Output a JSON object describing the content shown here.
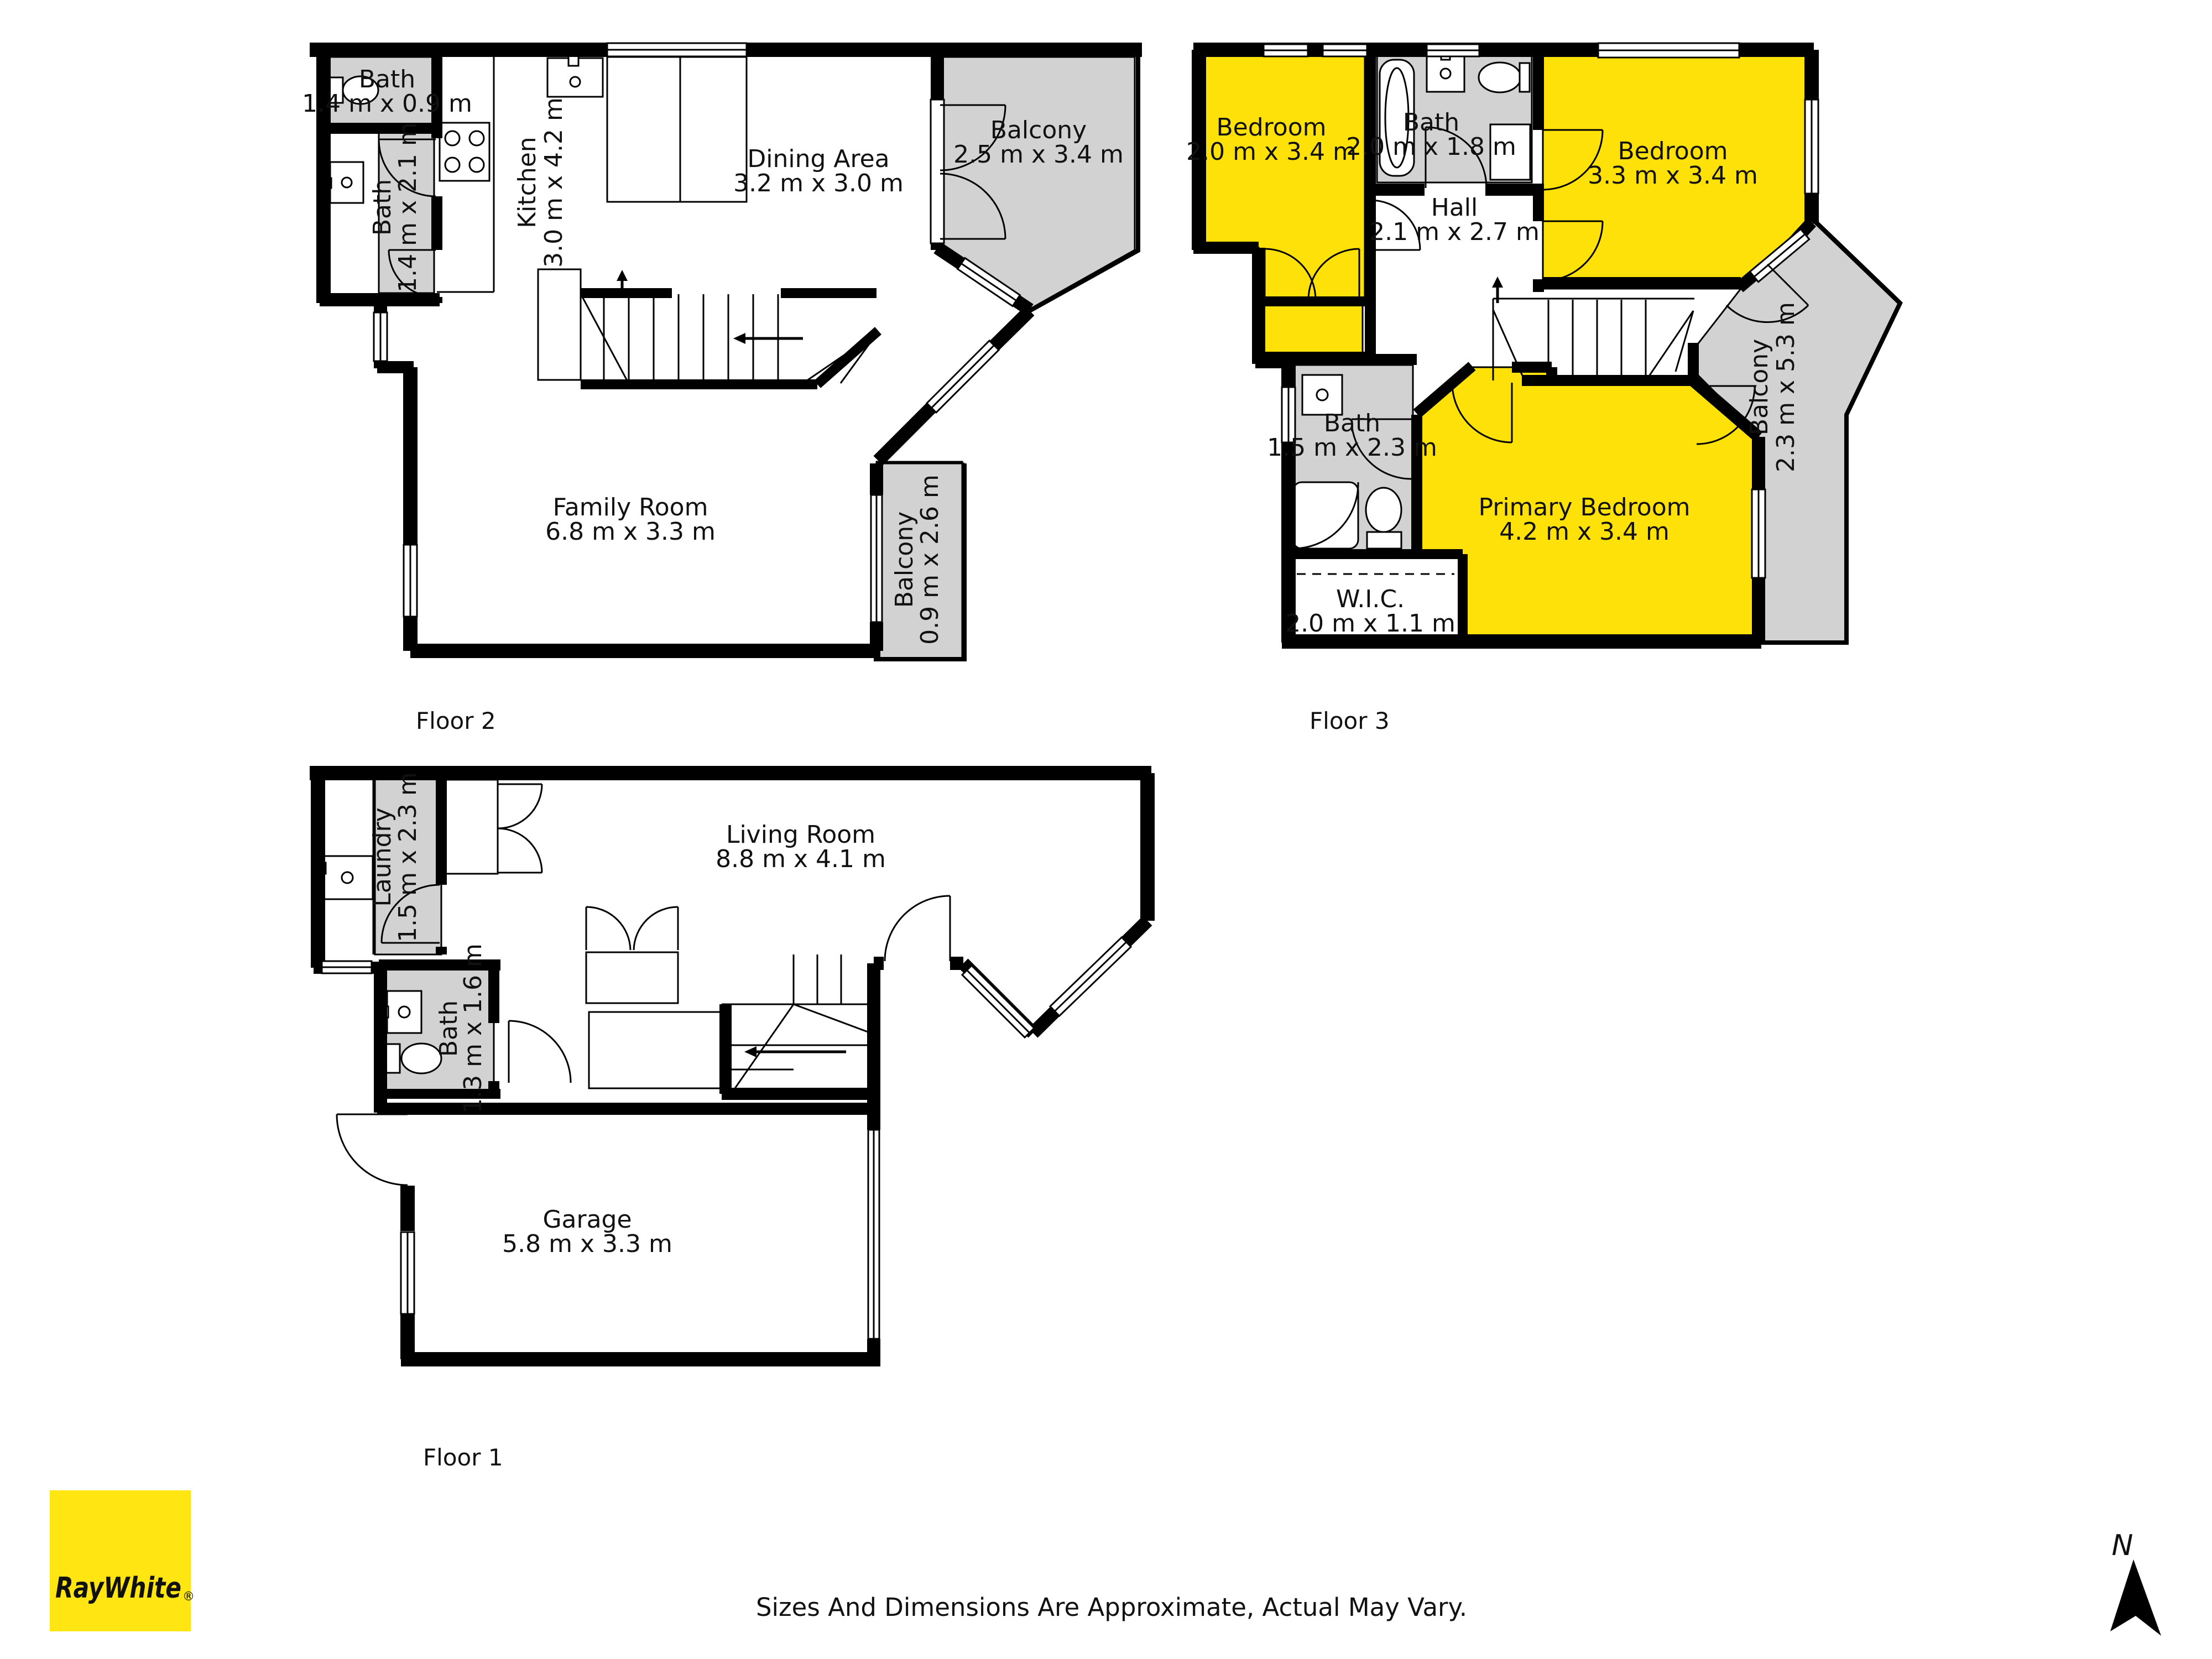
{
  "colors": {
    "room_highlight": "#ffe10a",
    "outdoor_gray": "#d2d2d2",
    "wall": "#000000",
    "logo_bg": "#ffe512",
    "logo_fg": "#57585c"
  },
  "floor2": {
    "label": "Floor 2",
    "rooms": {
      "bath_a": {
        "name": "Bath",
        "dims": "1.4 m x 0.9 m"
      },
      "bath_b": {
        "name": "Bath",
        "dims": "1.4 m x 2.1 m"
      },
      "kitchen": {
        "name": "Kitchen",
        "dims": "3.0 m x 4.2 m"
      },
      "dining": {
        "name": "Dining Area",
        "dims": "3.2 m x 3.0 m"
      },
      "balcony_a": {
        "name": "Balcony",
        "dims": "2.5 m x 3.4 m"
      },
      "family": {
        "name": "Family Room",
        "dims": "6.8 m x 3.3 m"
      },
      "balcony_b": {
        "name": "Balcony",
        "dims": "0.9 m x 2.6 m"
      }
    }
  },
  "floor3": {
    "label": "Floor 3",
    "rooms": {
      "bedroom_a": {
        "name": "Bedroom",
        "dims": "2.0 m x 3.4 m"
      },
      "bath_a": {
        "name": "Bath",
        "dims": "2.0 m x 1.8 m"
      },
      "bedroom_b": {
        "name": "Bedroom",
        "dims": "3.3 m x 3.4 m"
      },
      "hall": {
        "name": "Hall",
        "dims": "2.1 m x 2.7 m"
      },
      "balcony": {
        "name": "Balcony",
        "dims": "2.3 m x 5.3 m"
      },
      "bath_b": {
        "name": "Bath",
        "dims": "1.5 m x 2.3 m"
      },
      "primary": {
        "name": "Primary Bedroom",
        "dims": "4.2 m x 3.4 m"
      },
      "wic": {
        "name": "W.I.C.",
        "dims": "2.0 m x 1.1 m"
      }
    }
  },
  "floor1": {
    "label": "Floor 1",
    "rooms": {
      "laundry": {
        "name": "Laundry",
        "dims": "1.5 m x 2.3 m"
      },
      "living": {
        "name": "Living Room",
        "dims": "8.8 m x 4.1 m"
      },
      "bath": {
        "name": "Bath",
        "dims": "1.3 m x 1.6 m"
      },
      "garage": {
        "name": "Garage",
        "dims": "5.8 m x 3.3 m"
      }
    }
  },
  "footer": {
    "disclaimer": "Sizes And Dimensions Are Approximate, Actual May Vary."
  },
  "branding": {
    "logo_text": "RayWhite",
    "registered": "®"
  },
  "compass": {
    "north_label": "N"
  }
}
